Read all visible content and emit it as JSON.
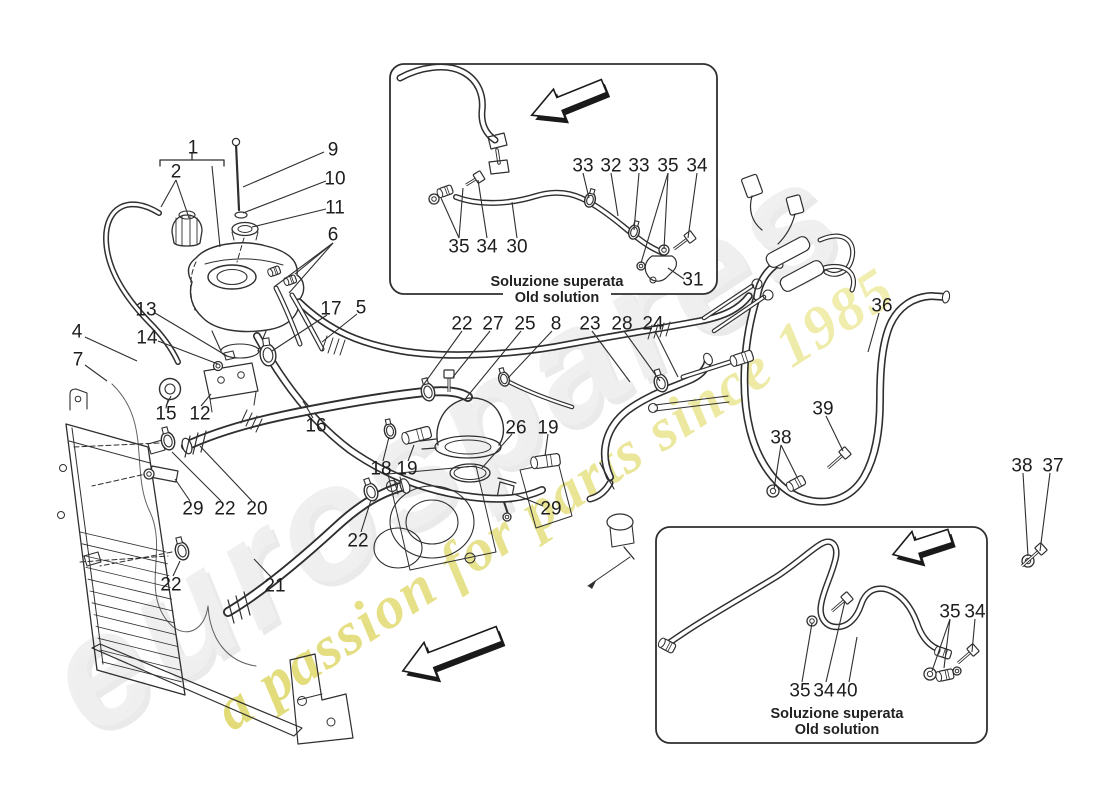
{
  "watermark": {
    "brand": "eurospares",
    "tagline": "a passion for parts since 1985",
    "brand_color": "#e7e7e7",
    "tagline_color_start": "#d5cb40",
    "tagline_color_end": "#f0eda6"
  },
  "diagram": {
    "line_color": "#2f2f2f",
    "labels": [
      {
        "t": "1",
        "x": 193,
        "y": 147
      },
      {
        "t": "2",
        "x": 176,
        "y": 171
      },
      {
        "t": "9",
        "x": 333,
        "y": 149
      },
      {
        "t": "10",
        "x": 335,
        "y": 178
      },
      {
        "t": "11",
        "x": 335,
        "y": 207
      },
      {
        "t": "6",
        "x": 333,
        "y": 234
      },
      {
        "t": "13",
        "x": 146,
        "y": 309
      },
      {
        "t": "14",
        "x": 147,
        "y": 337
      },
      {
        "t": "4",
        "x": 77,
        "y": 331
      },
      {
        "t": "7",
        "x": 78,
        "y": 359
      },
      {
        "t": "17",
        "x": 331,
        "y": 308
      },
      {
        "t": "5",
        "x": 361,
        "y": 307
      },
      {
        "t": "15",
        "x": 166,
        "y": 413
      },
      {
        "t": "12",
        "x": 200,
        "y": 413
      },
      {
        "t": "16",
        "x": 316,
        "y": 425
      },
      {
        "t": "22",
        "x": 462,
        "y": 323
      },
      {
        "t": "27",
        "x": 493,
        "y": 323
      },
      {
        "t": "25",
        "x": 525,
        "y": 323
      },
      {
        "t": "8",
        "x": 556,
        "y": 323
      },
      {
        "t": "23",
        "x": 590,
        "y": 323
      },
      {
        "t": "28",
        "x": 622,
        "y": 323
      },
      {
        "t": "24",
        "x": 653,
        "y": 323
      },
      {
        "t": "26",
        "x": 516,
        "y": 427
      },
      {
        "t": "19",
        "x": 548,
        "y": 427
      },
      {
        "t": "18",
        "x": 381,
        "y": 468
      },
      {
        "t": "19",
        "x": 407,
        "y": 468
      },
      {
        "t": "29",
        "x": 551,
        "y": 508
      },
      {
        "t": "29",
        "x": 193,
        "y": 508
      },
      {
        "t": "22",
        "x": 225,
        "y": 508
      },
      {
        "t": "20",
        "x": 257,
        "y": 508
      },
      {
        "t": "22",
        "x": 171,
        "y": 584
      },
      {
        "t": "21",
        "x": 275,
        "y": 585
      },
      {
        "t": "22",
        "x": 358,
        "y": 540
      },
      {
        "t": "36",
        "x": 882,
        "y": 305
      },
      {
        "t": "39",
        "x": 823,
        "y": 408
      },
      {
        "t": "38",
        "x": 781,
        "y": 437
      },
      {
        "t": "38",
        "x": 1022,
        "y": 465
      },
      {
        "t": "37",
        "x": 1053,
        "y": 465
      }
    ],
    "leaders": [
      [
        212,
        166,
        220,
        247
      ],
      [
        176,
        180,
        161,
        207
      ],
      [
        176,
        180,
        189,
        218
      ],
      [
        324,
        152,
        243,
        187
      ],
      [
        326,
        181,
        243,
        213
      ],
      [
        326,
        209,
        252,
        227
      ],
      [
        333,
        243,
        295,
        274
      ],
      [
        333,
        243,
        274,
        287
      ],
      [
        333,
        243,
        289,
        293
      ],
      [
        155,
        313,
        227,
        356
      ],
      [
        158,
        341,
        218,
        364
      ],
      [
        85,
        337,
        137,
        361
      ],
      [
        85,
        365,
        107,
        381
      ],
      [
        327,
        315,
        272,
        351
      ],
      [
        357,
        314,
        322,
        342
      ],
      [
        166,
        406,
        171,
        396
      ],
      [
        201,
        406,
        211,
        394
      ],
      [
        313,
        418,
        303,
        401
      ],
      [
        462,
        331,
        424,
        384
      ],
      [
        490,
        331,
        453,
        377
      ],
      [
        521,
        331,
        466,
        398
      ],
      [
        552,
        331,
        508,
        378
      ],
      [
        592,
        331,
        630,
        382
      ],
      [
        624,
        331,
        660,
        381
      ],
      [
        655,
        331,
        678,
        377
      ],
      [
        512,
        434,
        482,
        468
      ],
      [
        548,
        434,
        545,
        456
      ],
      [
        383,
        461,
        389,
        437
      ],
      [
        408,
        461,
        414,
        445
      ],
      [
        543,
        506,
        514,
        494
      ],
      [
        190,
        501,
        175,
        479
      ],
      [
        221,
        501,
        172,
        452
      ],
      [
        252,
        501,
        200,
        446
      ],
      [
        173,
        576,
        180,
        561
      ],
      [
        271,
        577,
        254,
        559
      ],
      [
        361,
        532,
        371,
        500
      ],
      [
        879,
        313,
        868,
        352
      ],
      [
        826,
        416,
        843,
        451
      ],
      [
        781,
        445,
        774,
        489
      ],
      [
        781,
        445,
        797,
        477
      ],
      [
        1023,
        473,
        1028,
        556
      ],
      [
        1050,
        473,
        1040,
        551
      ]
    ],
    "insets": [
      {
        "caption_line1": "Soluzione superata",
        "caption_line2": "Old solution",
        "box": {
          "x": 390,
          "y": 64,
          "w": 327,
          "h": 230
        },
        "caption": {
          "cx": 557,
          "y1": 286,
          "y2": 302
        },
        "labels": [
          {
            "t": "33",
            "x": 583,
            "y": 165
          },
          {
            "t": "32",
            "x": 611,
            "y": 165
          },
          {
            "t": "33",
            "x": 639,
            "y": 165
          },
          {
            "t": "35",
            "x": 668,
            "y": 165
          },
          {
            "t": "34",
            "x": 697,
            "y": 165
          },
          {
            "t": "35",
            "x": 459,
            "y": 246
          },
          {
            "t": "34",
            "x": 487,
            "y": 246
          },
          {
            "t": "30",
            "x": 517,
            "y": 246
          },
          {
            "t": "31",
            "x": 693,
            "y": 279
          }
        ],
        "leaders": [
          [
            583,
            173,
            589,
            198
          ],
          [
            611,
            173,
            618,
            216
          ],
          [
            639,
            173,
            634,
            230
          ],
          [
            668,
            173,
            664,
            249
          ],
          [
            668,
            173,
            641,
            263
          ],
          [
            697,
            173,
            688,
            238
          ],
          [
            459,
            238,
            441,
            198
          ],
          [
            459,
            238,
            463,
            188
          ],
          [
            487,
            238,
            478,
            180
          ],
          [
            517,
            238,
            512,
            202
          ],
          [
            684,
            279,
            668,
            268
          ]
        ],
        "arrow": {
          "x": 604,
          "y": 86,
          "len": 78,
          "rot": -22
        }
      },
      {
        "caption_line1": "Soluzione superata",
        "caption_line2": "Old solution",
        "box": {
          "x": 656,
          "y": 527,
          "w": 331,
          "h": 216
        },
        "caption": {
          "cx": 837,
          "y1": 718,
          "y2": 734
        },
        "labels": [
          {
            "t": "35",
            "x": 950,
            "y": 611
          },
          {
            "t": "34",
            "x": 975,
            "y": 611
          },
          {
            "t": "35",
            "x": 800,
            "y": 690
          },
          {
            "t": "34",
            "x": 824,
            "y": 690
          },
          {
            "t": "40",
            "x": 847,
            "y": 690
          }
        ],
        "leaders": [
          [
            950,
            619,
            932,
            671
          ],
          [
            950,
            619,
            944,
            668
          ],
          [
            975,
            619,
            972,
            652
          ],
          [
            802,
            682,
            812,
            623
          ],
          [
            826,
            682,
            845,
            601
          ],
          [
            849,
            682,
            857,
            637
          ]
        ],
        "arrow": {
          "x": 950,
          "y": 536,
          "len": 60,
          "rot": -18
        }
      }
    ],
    "main_arrow": {
      "x": 499,
      "y": 634,
      "len": 103,
      "rot": -21
    }
  }
}
